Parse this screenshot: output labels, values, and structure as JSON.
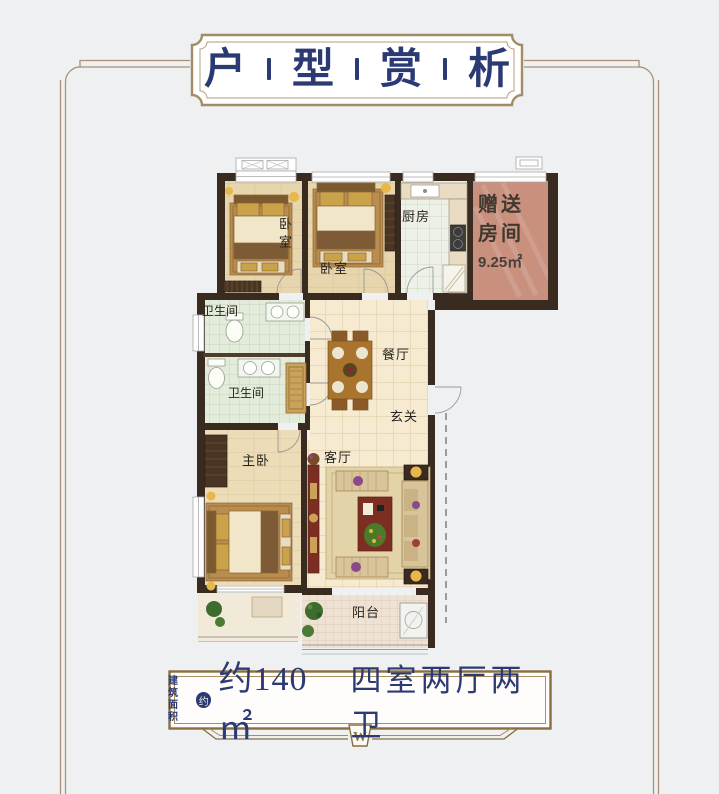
{
  "title": {
    "chars": [
      "户",
      "型",
      "赏",
      "析"
    ]
  },
  "plan": {
    "rooms": {
      "bedroom_left": "卧室",
      "bedroom_mid": "卧室",
      "kitchen": "厨房",
      "gift_line1": "赠送",
      "gift_line2": "房间",
      "gift_area": "9.25㎡",
      "bath_upper": "卫生间",
      "bath_lower": "卫生间",
      "dining": "餐厅",
      "entry": "玄关",
      "master": "主卧",
      "living": "客厅",
      "balcony": "阳台"
    }
  },
  "footer": {
    "prefix_line1": "建筑",
    "prefix_line2": "面积",
    "seal": "约",
    "area_value": "约140㎡",
    "layout_text": "四室两厅两卫",
    "emblem": "W"
  },
  "colors": {
    "navy": "#2c3a73",
    "frame_tan": "#ab9176",
    "banner_brown": "#8a6e41",
    "wall": "#3a2b20",
    "gift_fill": "#c9907e",
    "background": "#eef0f1"
  }
}
